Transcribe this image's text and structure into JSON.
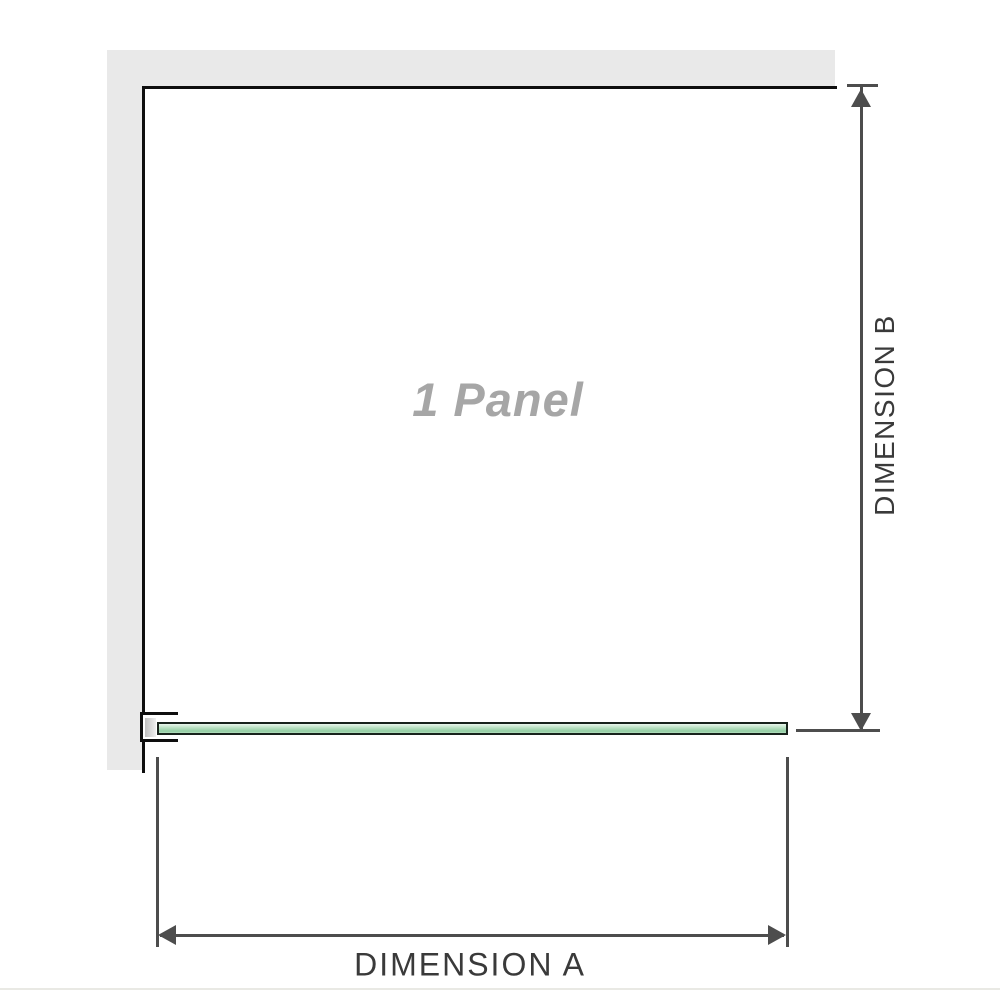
{
  "diagram": {
    "panel_label": "1 Panel",
    "dimension_a_label": "DIMENSION A",
    "dimension_b_label": "DIMENSION B"
  },
  "colors": {
    "wall": "#e9e9e9",
    "structure-line": "#0e0e0e",
    "dim-line": "#4d4d4d",
    "label-text": "#3a3a3a",
    "watermark-text": "#a6a6a6",
    "glass-border": "#17221b",
    "glass-light": "#eaf6ec",
    "glass-mid": "#b5dfbf",
    "glass-deep": "#92cda3",
    "bracket-shade-dark": "#c0c0c0",
    "bracket-shade-light": "#efefef",
    "page-rule": "#e9e9e4"
  }
}
